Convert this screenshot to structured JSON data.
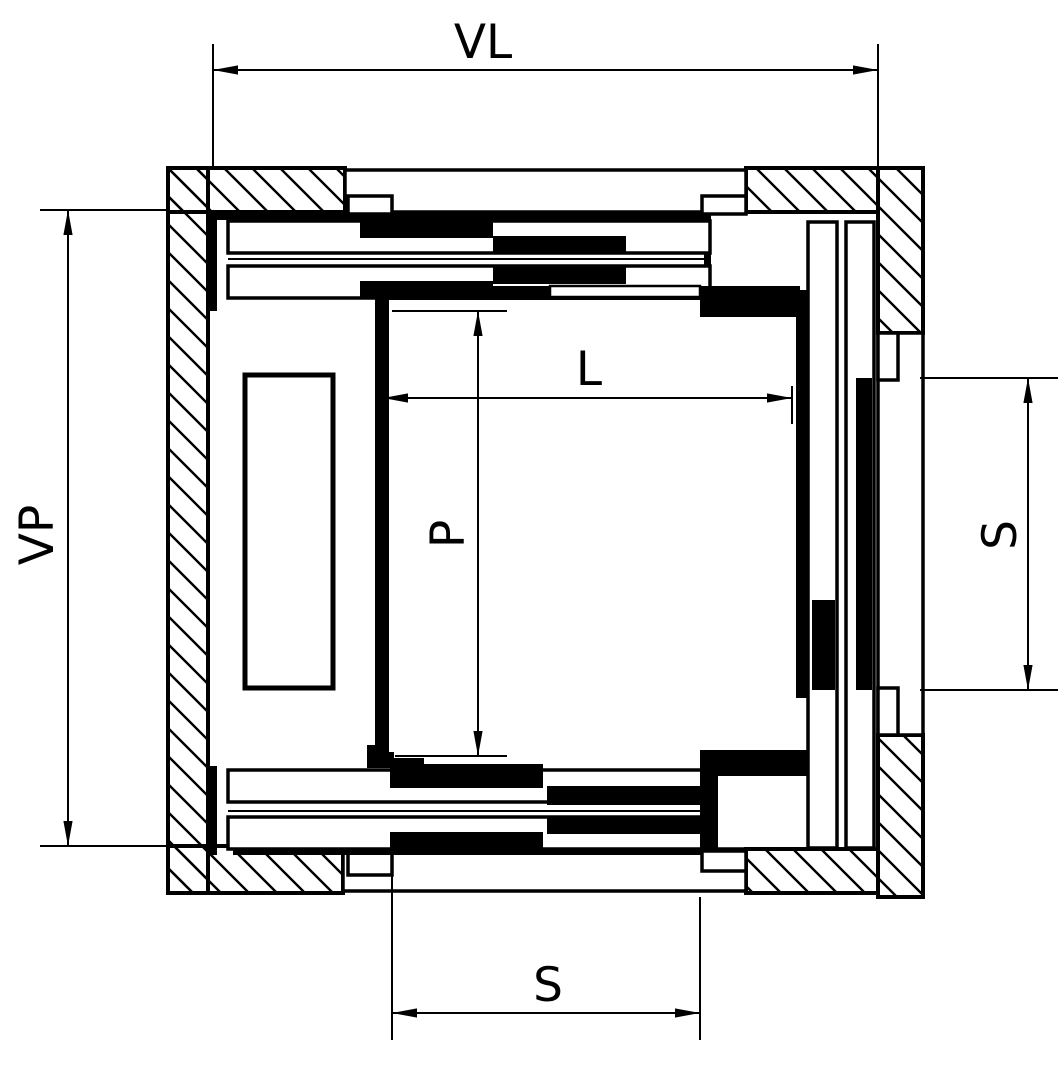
{
  "drawing": {
    "kind": "elevator-shaft-plan-section",
    "colors": {
      "ink": "#000000",
      "paper": "#ffffff"
    },
    "labels": {
      "shaft_width": "VL",
      "shaft_depth": "VP",
      "car_width": "L",
      "car_depth": "P",
      "door_side": "S",
      "door_bottom": "S"
    }
  }
}
